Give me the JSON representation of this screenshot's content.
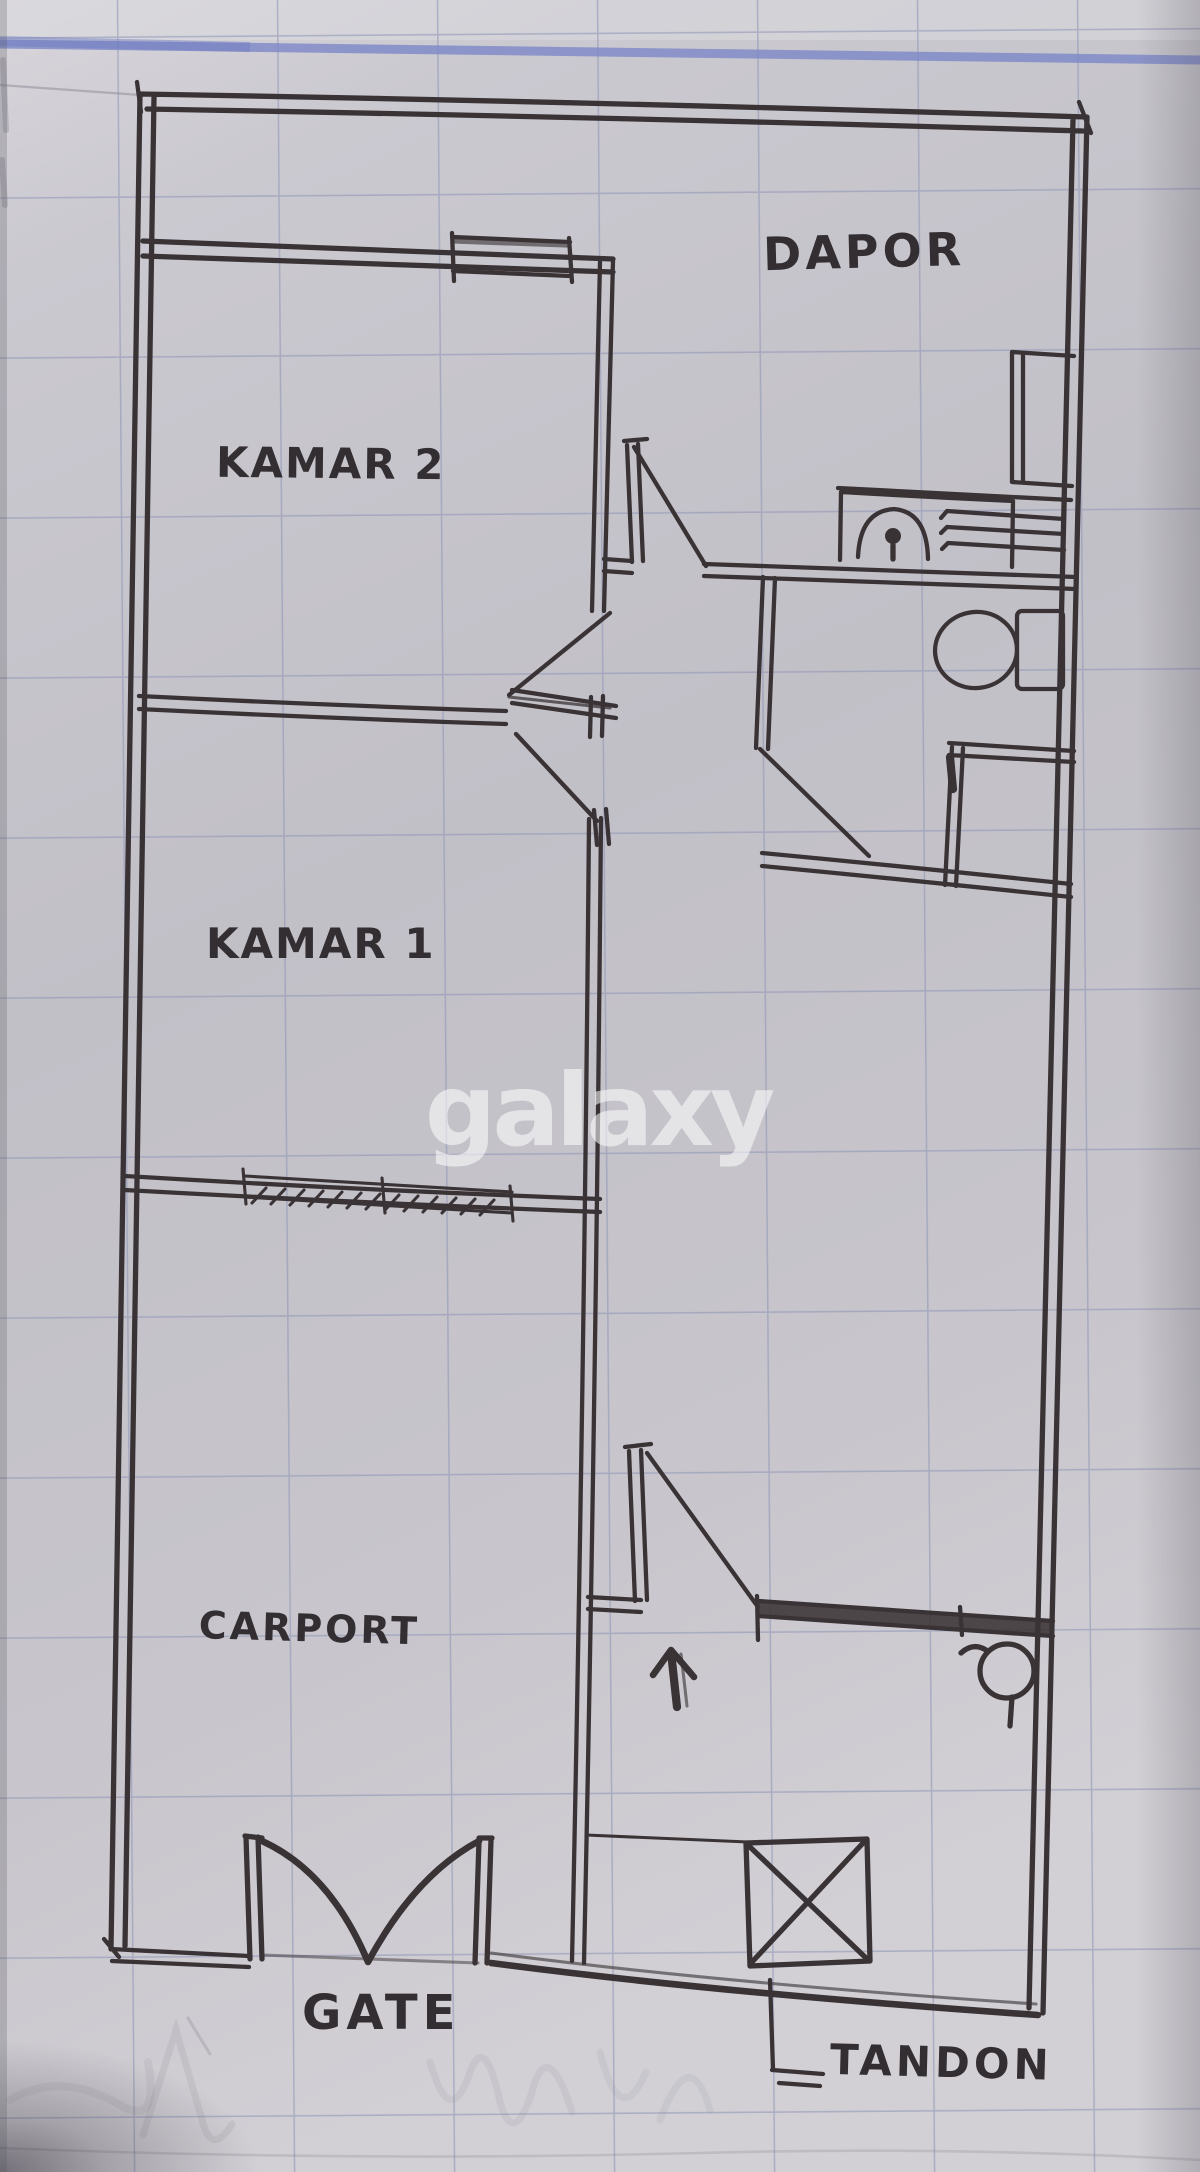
{
  "sketch": {
    "type": "hand-drawn floor plan on graph paper (photo)",
    "watermark": "galaxy",
    "labels": {
      "dapor": "DAPOR",
      "kamar2": "KAMAR 2",
      "kamar1": "KAMAR 1",
      "carport": "CARPORT",
      "gate": "GATE",
      "tandon": "TANDON"
    },
    "symbols": [
      "window-on-wall",
      "door-swing",
      "toilet",
      "shower-stall",
      "stove-counter",
      "kitchen-cabinet",
      "entry-arrow",
      "tap-circle",
      "gate-swing-arcs",
      "tandon-crossed-box"
    ],
    "colors": {
      "ink": "#3a3336",
      "paper": "#c6c4cb",
      "grid": "#8d94b5",
      "ruled_line": "#7c87c7",
      "watermark": "#ffffff",
      "pencil": "#8b8793"
    }
  }
}
